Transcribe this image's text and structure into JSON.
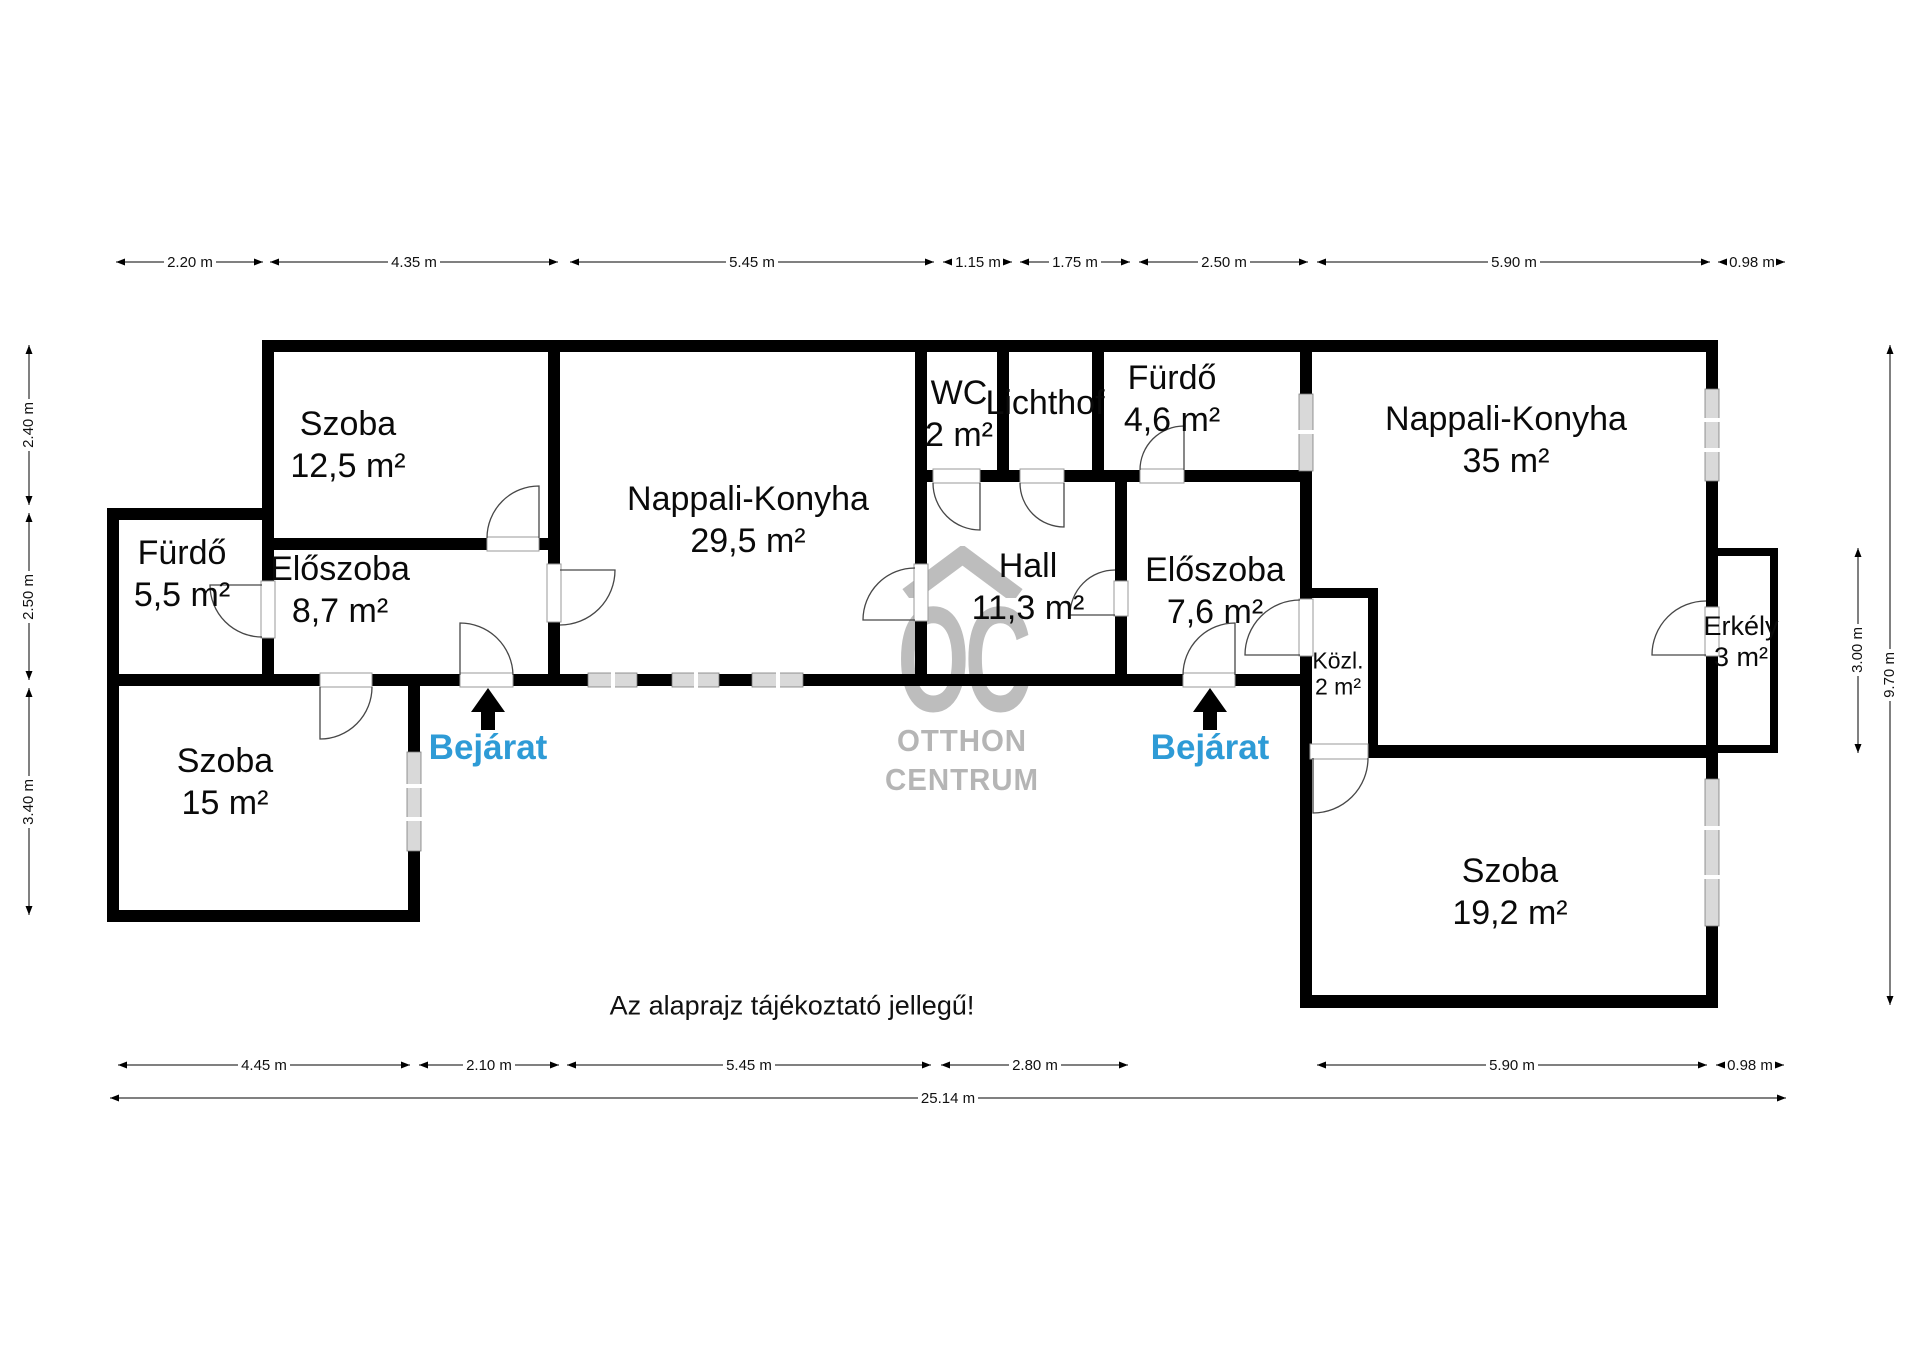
{
  "disclaimer": "Az alaprajz tájékoztató jellegű!",
  "watermark": {
    "logo": "OC",
    "brand_line1": "OTTHON",
    "brand_line2": "CENTRUM"
  },
  "colors": {
    "entrance": "#2E9BD6",
    "wall": "#000000",
    "watermark": "#bdbdbd",
    "window_fill": "#d9d9d9"
  },
  "entrances": {
    "left": "Bejárat",
    "right": "Bejárat"
  },
  "rooms": {
    "szoba_topleft": {
      "name": "Szoba",
      "area": "12,5 m²"
    },
    "nappali_konyha_left": {
      "name": "Nappali-Konyha",
      "area": "29,5 m²"
    },
    "wc": {
      "name": "WC",
      "area": "2 m²"
    },
    "lichthof": {
      "name": "Lichthof",
      "area": ""
    },
    "furdo_right": {
      "name": "Fürdő",
      "area": "4,6 m²"
    },
    "nappali_konyha_right": {
      "name": "Nappali-Konyha",
      "area": "35 m²"
    },
    "furdo_left": {
      "name": "Fürdő",
      "area": "5,5 m²"
    },
    "eloszoba_left": {
      "name": "Előszoba",
      "area": "8,7 m²"
    },
    "hall": {
      "name": "Hall",
      "area": "11,3 m²"
    },
    "eloszoba_right": {
      "name": "Előszoba",
      "area": "7,6 m²"
    },
    "kozl": {
      "name": "Közl.",
      "area": "2 m²"
    },
    "erkely": {
      "name": "Erkély",
      "area": "3 m²"
    },
    "szoba_bottomleft": {
      "name": "Szoba",
      "area": "15 m²"
    },
    "szoba_bottomright": {
      "name": "Szoba",
      "area": "19,2 m²"
    }
  },
  "dimensions": {
    "top": [
      "2.20 m",
      "4.35 m",
      "5.45 m",
      "1.15 m",
      "1.75 m",
      "2.50 m",
      "5.90 m",
      "0.98 m"
    ],
    "bottom": [
      "4.45 m",
      "2.10 m",
      "5.45 m",
      "2.80 m",
      "5.90 m",
      "0.98 m"
    ],
    "total_width": "25.14 m",
    "left": [
      "2.40 m",
      "2.50 m",
      "3.40 m"
    ],
    "right": [
      "3.00 m",
      "9.70 m"
    ]
  }
}
